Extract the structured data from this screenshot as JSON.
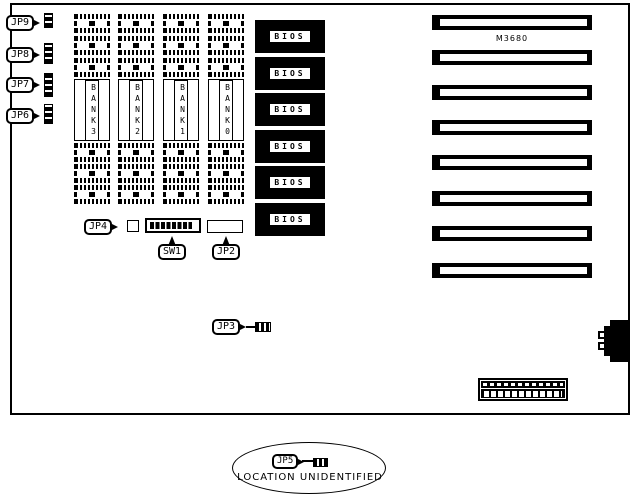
{
  "diagram": {
    "model": "M3680",
    "jumpers": {
      "jp9": "JP9",
      "jp8": "JP8",
      "jp7": "JP7",
      "jp6": "JP6",
      "jp4": "JP4",
      "jp3": "JP3",
      "jp2": "JP2",
      "jp5": "JP5"
    },
    "switch_label": "SW1",
    "banks": [
      "BANK3",
      "BANK2",
      "BANK1",
      "BANK0"
    ],
    "bios_label": "BIOS",
    "footnote": "LOCATION UNIDENTIFIED"
  }
}
